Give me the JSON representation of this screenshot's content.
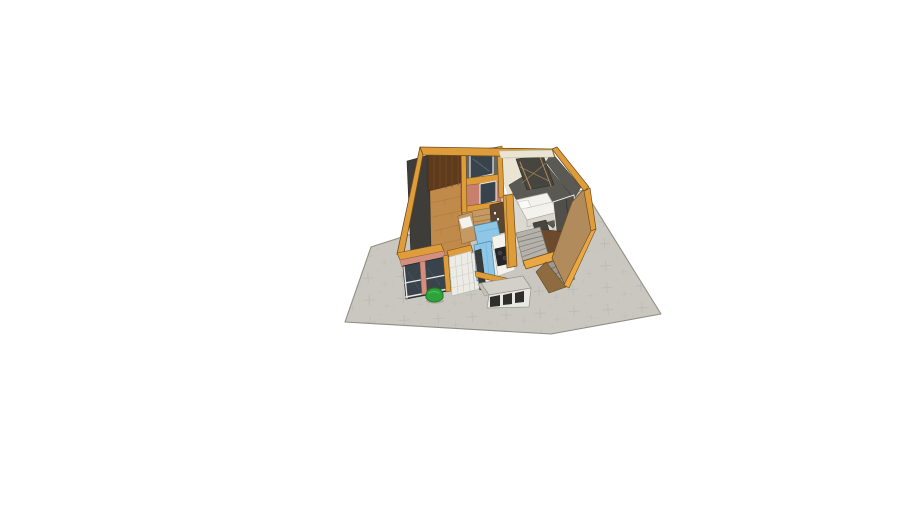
{
  "viewport": {
    "width": 910,
    "height": 512,
    "background_color": "#ffffff",
    "description": "3D dollhouse-style cutaway model of a small one-storey house with open top, viewed from above on a gray paved stone terrace, white empty background"
  },
  "scene": {
    "objects": [
      "paved stone terrace",
      "timber-framed house shell with orange wall tops",
      "living room with parquet floor and dark brown panel wall",
      "small back room with window",
      "salmon partition wall with window",
      "cream storage room with dark shelving",
      "bedroom with white bed, nightstand and dark wardrobe",
      "kitchen with wood cabinets, blue table and bench, white counter, stove",
      "two-flight staircase with landing",
      "tan exterior side wall",
      "front facade windows with salmon frames",
      "white tiled half wall",
      "white planter box with three dark insets",
      "green bush on pavement"
    ],
    "colors": {
      "background": "#ffffff",
      "pavement": "#cac7c0",
      "pavementMark": "#b3afa7",
      "orange": "#df9c3b",
      "orangeBright": "#eaa742",
      "cream": "#eae4d3",
      "darkWall": "#3e3d39",
      "grayWall": "#67665f",
      "grayWall2": "#5a5954",
      "brownWall": "#5f3b1d",
      "chocolate": "#6b4a2e",
      "tan": "#b28b5c",
      "tanDark": "#8f6c40",
      "salmon": "#c97f6e",
      "salmonLight": "#d4907f",
      "parquet": "#c08a4b",
      "tile": "#ecebe5",
      "floorLight": "#dcd9d2",
      "blue": "#8dc6e6",
      "white": "#f3f2ed",
      "whiteShade": "#d8d6cf",
      "stairs": "#b5b2ab",
      "stairsDark": "#9b9890",
      "glass": "#39434c",
      "stove": "#26262a",
      "furnDark": "#46453f",
      "hutch": "#5a4630",
      "shelfWood": "#c49a62",
      "wardrobe": "#504f4a",
      "darkOpening": "#3a3a36",
      "boxTop": "#d2d0c9",
      "boxFront": "#e9e7e1",
      "boxSquare": "#2f2e2b",
      "bush": "#2ea33b",
      "bushDark": "#1d7a27",
      "shadow": "#9a968e"
    }
  }
}
